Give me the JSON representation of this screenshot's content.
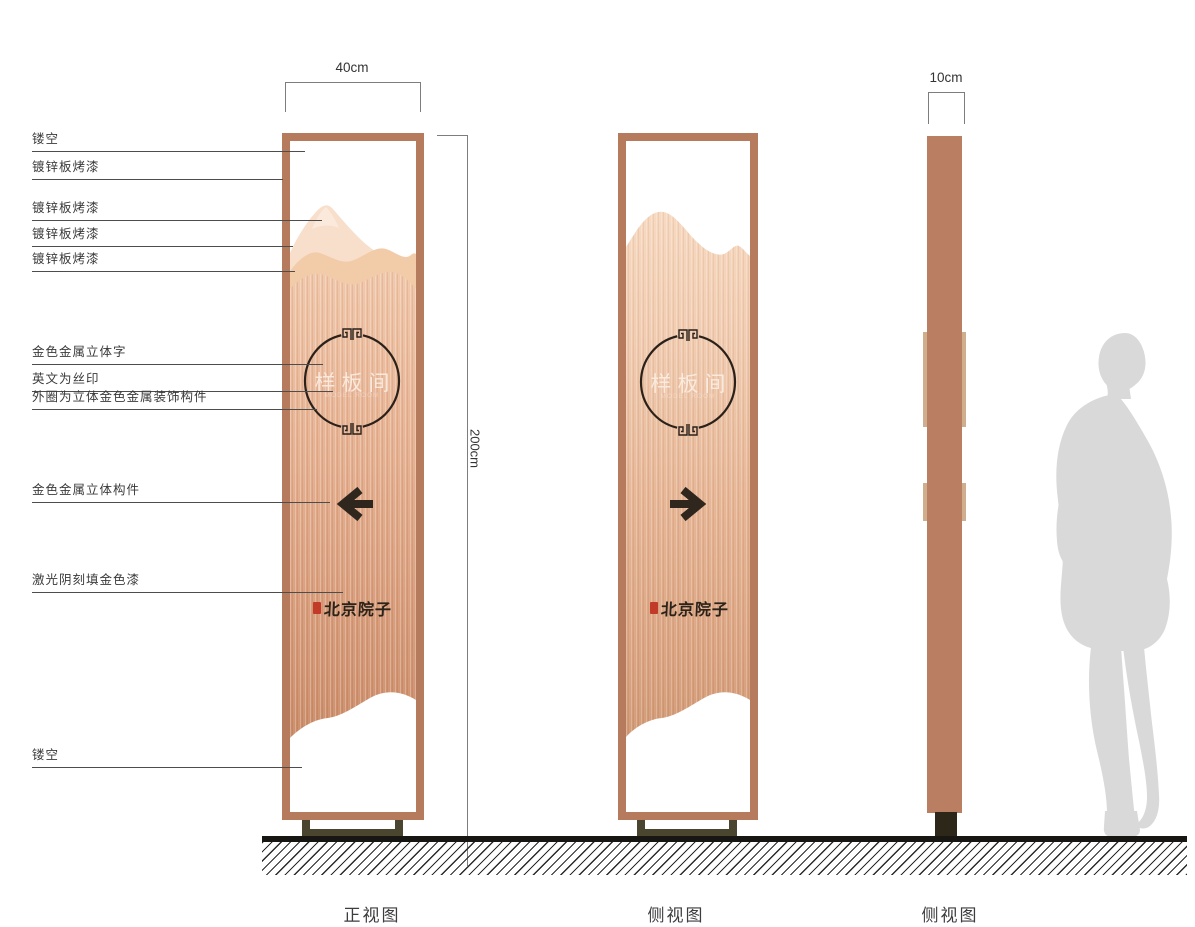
{
  "annotations": [
    {
      "label": "镂空"
    },
    {
      "label": "镀锌板烤漆"
    },
    {
      "label": "镀锌板烤漆"
    },
    {
      "label": "镀锌板烤漆"
    },
    {
      "label": "镀锌板烤漆"
    },
    {
      "label": "金色金属立体字"
    },
    {
      "label": "英文为丝印"
    },
    {
      "label": "外圈为立体金色金属装饰构件"
    },
    {
      "label": "金色金属立体构件"
    },
    {
      "label": "激光阴刻填金色漆"
    },
    {
      "label": "镂空"
    }
  ],
  "dimensions": {
    "front_width": "40cm",
    "height": "200cm",
    "side_width": "10cm"
  },
  "panel": {
    "name_text": "样板间",
    "name_text_en": "MODEL ROOM",
    "brand_text": "北京院子"
  },
  "views": [
    {
      "label": "正视图"
    },
    {
      "label": "侧视图"
    },
    {
      "label": "侧视图"
    }
  ],
  "colors": {
    "frame_copper": "#b67a5d",
    "body_light": "#f6d8bf",
    "body_dark": "#cc8e6a",
    "mountain_light": "#f8dfcc",
    "ink_dark": "#2f261e",
    "seal_red": "#c23a28",
    "base_olive": "#49452f",
    "profile_base_dark": "#2c2718",
    "silhouette_gray": "#d9d9d9"
  }
}
